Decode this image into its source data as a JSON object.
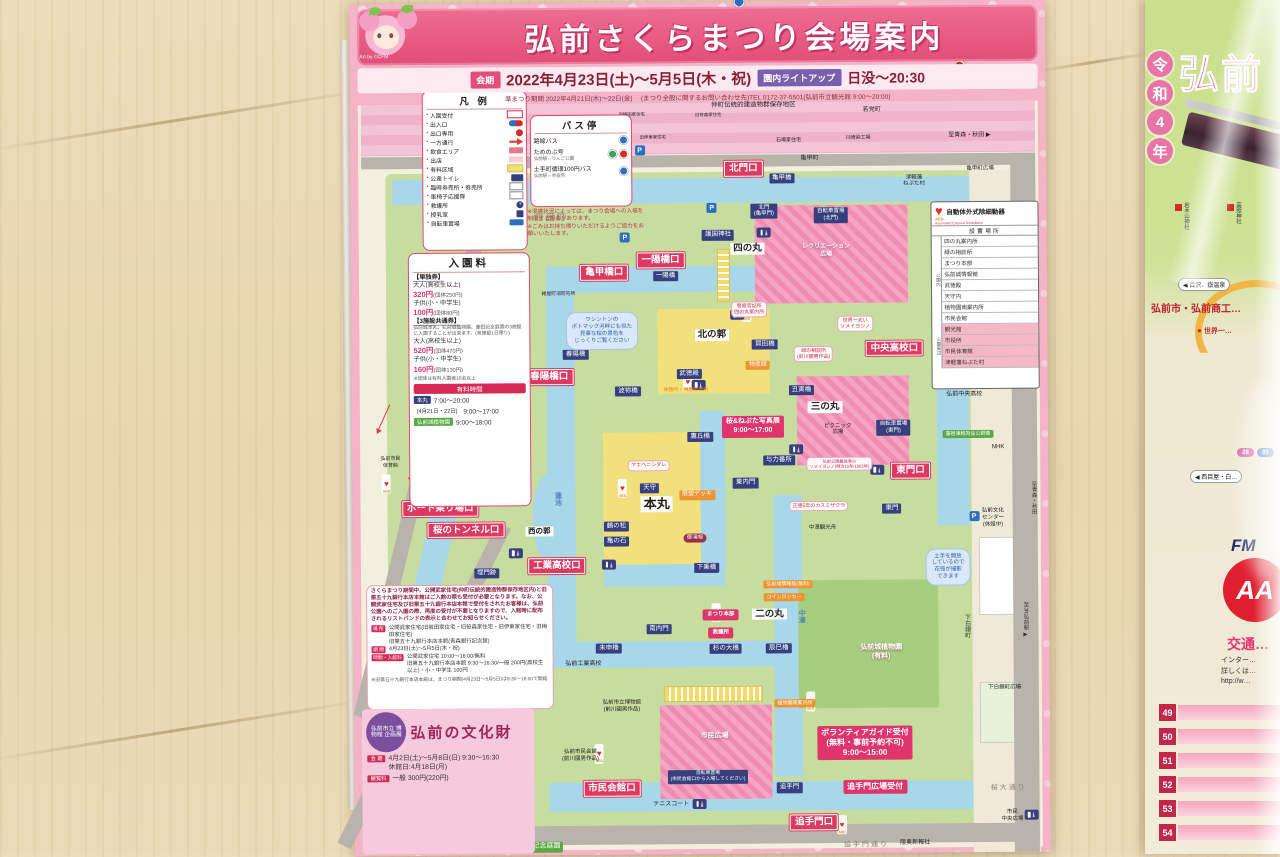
{
  "brochure": {
    "title": "弘前さくらまつり会場案内",
    "art_credit": "Art by ©CFM",
    "period_label": "会期",
    "period": "2022年4月23日(土)〜5月5日(木・祝)",
    "lightup_label": "園内ライトアップ",
    "lightup_time": "日没〜20:30",
    "sub_period": "準まつり期間 2022年4月21日(木)〜22日(金)",
    "contact": "(まつり全般に関するお問い合わせ先)TEL.0172-37-5501(弘前市立観光館 9:00〜20:00)"
  },
  "legend": {
    "title": "凡 例",
    "items": [
      {
        "label": "入園受付",
        "swatch": "reception"
      },
      {
        "label": "出入口",
        "swatch": "inout"
      },
      {
        "label": "出口専用",
        "swatch": "exit"
      },
      {
        "label": "一方通行",
        "swatch": "oneway"
      },
      {
        "label": "飲食エリア",
        "swatch": "food"
      },
      {
        "label": "出店",
        "swatch": "stall"
      },
      {
        "label": "有料区域",
        "swatch": "paid"
      },
      {
        "label": "公衆トイレ",
        "swatch": "toilet"
      },
      {
        "label": "臨時券売所・券売所",
        "swatch": "ticket"
      },
      {
        "label": "車椅子応援隊",
        "swatch": "wheel"
      },
      {
        "label": "救護所",
        "swatch": "aid"
      },
      {
        "label": "授乳室",
        "swatch": "nursing"
      },
      {
        "label": "自転車置場",
        "swatch": "bicycle"
      }
    ]
  },
  "bus": {
    "title": "バス停",
    "items": [
      {
        "label": "路線バス",
        "sub": "",
        "marks": [
          "b"
        ]
      },
      {
        "label": "ためのぶ号",
        "sub": "弘前駅⇔りんご公園",
        "marks": [
          "g",
          "r"
        ]
      },
      {
        "label": "土手町循環100円バス",
        "sub": "弘前駅⇔市役所",
        "marks": [
          "b"
        ]
      }
    ],
    "notes": [
      "※混雑状況によっては、まつり会場への入場を制限する場合があります。",
      "※ごみはお持ち帰りいただけるようご協力をお願いいたします。"
    ]
  },
  "admission": {
    "title": "入園料",
    "single_label": "【単独券】",
    "single": [
      {
        "who": "大人(高校生以上)",
        "price": "320円",
        "group": "(団体250円)"
      },
      {
        "who": "子供(小・中学生)",
        "price": "100円",
        "group": "(団体80円)"
      }
    ],
    "combo_label": "【3施設共通券】",
    "combo_desc": "弘前城本丸、弘前城植物園、藤田記念庭園の3施設に入園することが出来ます。(各施設1日限り)",
    "combo": [
      {
        "who": "大人(高校生以上)",
        "price": "520円",
        "group": "(団体470円)"
      },
      {
        "who": "子供(小・中学生)",
        "price": "160円",
        "group": "(団体130円)"
      }
    ],
    "group_note": "※団体は有料入園者10名以上",
    "hours_label": "有料時間",
    "hours": [
      {
        "chip": "本丸",
        "style": "navy",
        "time": "7:00〜20:00"
      },
      {
        "chip": "[4月21日・22日]",
        "style": "plain",
        "time": "9:00〜17:00"
      },
      {
        "chip": "弘前城植物園",
        "style": "green",
        "time": "9:00〜18:00"
      }
    ]
  },
  "aed": {
    "logo": "AED",
    "title": "自動体外式除細動器",
    "subtitle": "Automated External Defibrillator",
    "header": "設置場所",
    "in_park_label": "公園内",
    "in_park": [
      "四の丸案内所",
      "緑の相談所",
      "まつり本部",
      "弘前城情報館",
      "武徳殿",
      "天守内",
      "植物園南案内所",
      "市民会館"
    ],
    "around_label": "公園周辺",
    "around": [
      "観光館",
      "市役所",
      "市民体育館",
      "津軽藩ねぷた村"
    ]
  },
  "notice": {
    "text": "さくらまつり期間中、公開武家住宅(仲町伝統的建造物群保存地区内)と旧第五十九銀行本店本館はご入館の際も受付が必要となります。なお、公開武家住宅及び旧第五十九銀行本店本館で受付をされたお客様は、弘前公園へのご入園の際、再度の受付が不要となりますので、入館時に配布されるリストバンドの表示と合わせてお知らせください。",
    "rows": [
      {
        "chip": "場 所",
        "text": "公開武家住宅(旧岩田家住宅・旧笹森家住宅・旧伊東家住宅・旧梅田家住宅)\n旧第五十九銀行本店本館(青森銀行記念館)"
      },
      {
        "chip": "期 間",
        "text": "4月23日(土)〜5月5日(木・祝)"
      },
      {
        "chip": "時間・入館料",
        "text": "公開武家住宅 10:00〜16:00/無料\n旧第五十九銀行本店本館 9:30〜16:30/一般 200円(高校生以上)・小・中学生 100円"
      }
    ],
    "footnote": "※旧第五十九銀行本店本館は、まつり期間(4月23日〜5月5日)は9:30〜18:00で開館"
  },
  "bunkazai": {
    "badge": "弘前市立 博物館 企画展",
    "title": "弘前の文化財",
    "rows": [
      {
        "chip": "会 期",
        "text": "4月2日(土)〜5月8日(日) 9:30〜16:30\n休館日:4月18日(月)"
      },
      {
        "chip": "観覧料",
        "text": "一般 300円(220円)"
      }
    ]
  },
  "map": {
    "labels": [
      {
        "t": "北門口",
        "k": "g",
        "x": 56.5,
        "y": 19.6
      },
      {
        "t": "一陽橋口",
        "k": "g",
        "x": 44.5,
        "y": 30.3
      },
      {
        "t": "亀甲橋口",
        "k": "g",
        "x": 36.4,
        "y": 31.7
      },
      {
        "t": "春陽橋口",
        "k": "g",
        "x": 28.4,
        "y": 43.9
      },
      {
        "t": "市民体育館口",
        "k": "g",
        "x": 14.5,
        "y": 55.8
      },
      {
        "t": "ボート乗り場口",
        "k": "g",
        "x": 12.6,
        "y": 59.3
      },
      {
        "t": "桜のトンネル口",
        "k": "g",
        "x": 16.3,
        "y": 61.8
      },
      {
        "t": "工業高校口",
        "k": "g",
        "x": 29.3,
        "y": 66.1
      },
      {
        "t": "中央高校口",
        "k": "g",
        "x": 78,
        "y": 40.8
      },
      {
        "t": "東門口",
        "k": "g",
        "x": 80.2,
        "y": 55.2
      },
      {
        "t": "市民会館口",
        "k": "g",
        "x": 37,
        "y": 92.3
      },
      {
        "t": "追手門口",
        "k": "g",
        "x": 66,
        "y": 96.4
      },
      {
        "t": "亀甲橋",
        "k": "n",
        "x": 62,
        "y": 20.8
      },
      {
        "t": "北門\n(亀甲門)",
        "k": "n",
        "x": 59.4,
        "y": 24.6,
        "fs": 5.5
      },
      {
        "t": "自転車置場\n(北門)",
        "k": "n",
        "x": 69,
        "y": 25.1,
        "fs": 5.5
      },
      {
        "t": "護国神社",
        "k": "n",
        "x": 52.8,
        "y": 27.4
      },
      {
        "t": "一陽橋",
        "k": "n",
        "x": 45.2,
        "y": 32.2
      },
      {
        "t": "春陽橋",
        "k": "n",
        "x": 32.2,
        "y": 41.3
      },
      {
        "t": "波祢橋",
        "k": "n",
        "x": 39.7,
        "y": 45.7
      },
      {
        "t": "武徳殿",
        "k": "n",
        "x": 48.5,
        "y": 43.7
      },
      {
        "t": "賀田橋",
        "k": "n",
        "x": 59.4,
        "y": 40.2
      },
      {
        "t": "丑寅櫓",
        "k": "n",
        "x": 64.6,
        "y": 45.6
      },
      {
        "t": "鷹丘橋",
        "k": "n",
        "x": 50,
        "y": 51
      },
      {
        "t": "天守",
        "k": "n",
        "x": 42.7,
        "y": 57
      },
      {
        "t": "与力番所",
        "k": "n",
        "x": 61.3,
        "y": 53.9
      },
      {
        "t": "東内門",
        "k": "n",
        "x": 56.5,
        "y": 56.5
      },
      {
        "t": "鶴の松",
        "k": "n",
        "x": 37.9,
        "y": 61.5
      },
      {
        "t": "亀の石",
        "k": "n",
        "x": 37.9,
        "y": 63.3
      },
      {
        "t": "下乗橋",
        "k": "n",
        "x": 50.8,
        "y": 66.4
      },
      {
        "t": "南内門",
        "k": "n",
        "x": 43.9,
        "y": 73.6
      },
      {
        "t": "未申櫓",
        "k": "n",
        "x": 36.7,
        "y": 75.8
      },
      {
        "t": "杉の大橋",
        "k": "n",
        "x": 53.5,
        "y": 75.9
      },
      {
        "t": "辰巳櫓",
        "k": "n",
        "x": 61.1,
        "y": 75.9
      },
      {
        "t": "埋門跡",
        "k": "n",
        "x": 19.2,
        "y": 66.9
      },
      {
        "t": "東門",
        "k": "n",
        "x": 77.5,
        "y": 59.6
      },
      {
        "t": "追手門",
        "k": "n",
        "x": 62.5,
        "y": 92.3
      },
      {
        "t": "自転車置場\n(東門)",
        "k": "n",
        "x": 77.8,
        "y": 50.1,
        "fs": 5.5
      },
      {
        "t": "自転車置場\n(市民会館口から入場してください)",
        "k": "n",
        "x": 50.8,
        "y": 91,
        "fs": 4.8
      },
      {
        "t": "四の丸",
        "k": "w",
        "x": 57,
        "y": 29
      },
      {
        "t": "北の郭",
        "k": "w",
        "x": 51.8,
        "y": 39.1
      },
      {
        "t": "三の丸",
        "k": "w",
        "x": 68,
        "y": 47.7
      },
      {
        "t": "本丸",
        "k": "w",
        "x": 43.7,
        "y": 58.9,
        "fs": 13
      },
      {
        "t": "二の丸",
        "k": "w",
        "x": 59.8,
        "y": 71.9
      },
      {
        "t": "西の郭",
        "k": "w",
        "x": 26.8,
        "y": 62,
        "fs": 7.5
      },
      {
        "t": "市民広場",
        "k": "wl",
        "x": 51.8,
        "y": 86.3
      },
      {
        "t": "レクリエーション\n広場",
        "k": "wl",
        "x": 68.3,
        "y": 29.4,
        "fs": 6
      },
      {
        "t": "弘前城植物園\n(有料)",
        "k": "wl",
        "x": 75.8,
        "y": 76.5
      },
      {
        "t": "展望デッキ",
        "k": "o",
        "x": 49.5,
        "y": 57.9
      },
      {
        "t": "物産館",
        "k": "o",
        "x": 58.4,
        "y": 42.7
      },
      {
        "t": "弘前城情報館(無料)",
        "k": "o",
        "x": 62.5,
        "y": 68.4,
        "fs": 5
      },
      {
        "t": "コインロッカー",
        "k": "o",
        "x": 61.9,
        "y": 69.9,
        "fs": 5
      },
      {
        "t": "植物園南案内所",
        "k": "o",
        "x": 63.4,
        "y": 82.4,
        "fs": 5
      },
      {
        "t": "休憩所・物産販売所",
        "k": "ot",
        "x": 48,
        "y": 45.5
      },
      {
        "t": "桜&ねぷた写真展\n9:00〜17:00",
        "k": "p",
        "x": 57.6,
        "y": 49.9
      },
      {
        "t": "まつり本部",
        "k": "p",
        "x": 52.8,
        "y": 72,
        "fs": 5.5
      },
      {
        "t": "救護所",
        "k": "p",
        "x": 52.8,
        "y": 74.1,
        "fs": 5.5
      },
      {
        "t": "ボランティアガイド受付\n(無料・事前予約不可)\n9:00〜15:00",
        "k": "p",
        "x": 73.4,
        "y": 87.1,
        "fs": 8
      },
      {
        "t": "追手門広場受付",
        "k": "p",
        "x": 74.8,
        "y": 92.3,
        "fs": 8
      },
      {
        "t": "御滝桜",
        "k": "d",
        "x": 49.2,
        "y": 62.9
      },
      {
        "t": "ヤエベニシダレ",
        "k": "r",
        "x": 42.6,
        "y": 54.4
      },
      {
        "t": "正徳5年のカスミザクラ",
        "k": "r",
        "x": 67,
        "y": 59.3
      },
      {
        "t": "世界一太い\nソメイヨシノ",
        "k": "r",
        "x": 72.4,
        "y": 37.9
      },
      {
        "t": "緑の相談所\n(前川國男作品)",
        "k": "r",
        "x": 66.4,
        "y": 41.4
      },
      {
        "t": "警察官詰所\n四の丸案内所",
        "k": "r",
        "x": 57.2,
        "y": 36.1
      },
      {
        "t": "弘前公園最長寿の\nソメイヨシノ(明治15年/1882年)",
        "k": "r",
        "x": 70,
        "y": 54.3,
        "fs": 4.2
      },
      {
        "t": "ワシントンの\nポトマック河畔にも似た\n見事な桜の景色を\nじっくりご覧ください",
        "k": "c",
        "x": 36,
        "y": 38.5
      },
      {
        "t": "土手を開放\nしているので\n花筏が撮影\nできます",
        "k": "c",
        "x": 85.5,
        "y": 66.5
      },
      {
        "t": "紺屋町消防屯所",
        "k": "b",
        "x": 29.8,
        "y": 34.3,
        "fs": 4.8
      },
      {
        "t": "弘前市民\n体育館",
        "k": "b",
        "x": 5.5,
        "y": 53.8,
        "fs": 5
      },
      {
        "t": "弘前工業高校",
        "k": "b",
        "x": 33,
        "y": 77.7
      },
      {
        "t": "弘前中央高校",
        "k": "b",
        "x": 88,
        "y": 46.4
      },
      {
        "t": "NHK",
        "k": "b",
        "x": 92.8,
        "y": 52.6
      },
      {
        "t": "弘前文化\nセンター\n(休館中)",
        "k": "b",
        "x": 92,
        "y": 60.8,
        "fs": 5.5
      },
      {
        "t": "津軽藩\nねぷた村",
        "k": "b",
        "x": 81,
        "y": 21.2,
        "fs": 5.5
      },
      {
        "t": "亀甲町広場",
        "k": "b",
        "x": 90.5,
        "y": 19.8,
        "fs": 5.5
      },
      {
        "t": "川崎染工場",
        "k": "b",
        "x": 73,
        "y": 16.1,
        "fs": 5
      },
      {
        "t": "石場家住宅",
        "k": "b",
        "x": 63,
        "y": 16.3,
        "fs": 5
      },
      {
        "t": "旧梅田家住宅",
        "k": "b",
        "x": 40.5,
        "y": 13.2,
        "fs": 4.4
      },
      {
        "t": "旧伊東家住宅",
        "k": "b",
        "x": 43.5,
        "y": 15.9,
        "fs": 4.4
      },
      {
        "t": "旧笹森家住宅",
        "k": "b",
        "x": 51.5,
        "y": 13.3,
        "fs": 4.4
      },
      {
        "t": "仲町伝統的建造物群保存地区",
        "k": "b",
        "x": 58,
        "y": 12.2,
        "fs": 6.5
      },
      {
        "t": "若党町",
        "k": "b",
        "x": 75,
        "y": 12.9
      },
      {
        "t": "亀甲町",
        "k": "b",
        "x": 66,
        "y": 18.5
      },
      {
        "t": "ピクニック\n広場",
        "k": "b",
        "x": 69.8,
        "y": 50.3,
        "fs": 5.5
      },
      {
        "t": "中濠観光舟",
        "k": "b",
        "x": 67.5,
        "y": 61.9,
        "fs": 5.5
      },
      {
        "t": "下白銀町広場",
        "k": "b",
        "x": 93.5,
        "y": 80.8,
        "fs": 5.5
      },
      {
        "t": "桜大通り",
        "k": "gy",
        "x": 94,
        "y": 92.6,
        "fs": 7
      },
      {
        "t": "市民\n中央広場",
        "k": "b",
        "x": 94.5,
        "y": 95.8,
        "fs": 5.5
      },
      {
        "t": "陸奥新報社",
        "k": "b",
        "x": 80.5,
        "y": 99
      },
      {
        "t": "テニスコート",
        "k": "b",
        "x": 45.5,
        "y": 94.3
      },
      {
        "t": "弘前市立博物館\n(前川國男作品)",
        "k": "b",
        "x": 38.5,
        "y": 82.6,
        "fs": 5.5
      },
      {
        "t": "弘前市民会館\n(前川國男作品)",
        "k": "b",
        "x": 32.5,
        "y": 88.4,
        "fs": 5.5
      },
      {
        "t": "追手門通り",
        "k": "gy",
        "x": 73.5,
        "y": 99.2,
        "fs": 7
      },
      {
        "t": "至青森・秋田 ▶",
        "k": "b",
        "x": 89,
        "y": 16
      },
      {
        "t": "紺屋町",
        "k": "gy",
        "x": 28.8,
        "y": 25.2
      },
      {
        "t": "藩祖津軽為信公銅像",
        "k": "gr",
        "x": 88.5,
        "y": 50.9,
        "fs": 5
      },
      {
        "t": "藤田記念庭園",
        "k": "gr",
        "x": 26.5,
        "y": 99.1,
        "fs": 7
      },
      {
        "t": "中濠",
        "k": "vb",
        "x": 64.3,
        "y": 72.2,
        "v": true
      },
      {
        "t": "蓮池",
        "k": "vb",
        "x": 29.4,
        "y": 58.2,
        "v": true
      },
      {
        "t": "下白銀町",
        "k": "v",
        "x": 88,
        "y": 73.5,
        "v": true
      },
      {
        "t": "至JR弘前駅 ▶",
        "k": "v",
        "x": 96.5,
        "y": 72.8,
        "v": true,
        "fs": 5.5
      },
      {
        "t": "至青森・秋田",
        "k": "v",
        "x": 97.8,
        "y": 58.5,
        "v": true,
        "fs": 5.5
      }
    ],
    "icons": [
      {
        "k": "aed",
        "x": 38.8,
        "y": 57
      },
      {
        "k": "aed",
        "x": 52.1,
        "y": 71.7
      },
      {
        "k": "aed",
        "x": 65.6,
        "y": 82.2
      },
      {
        "k": "aed",
        "x": 35.2,
        "y": 88.2
      },
      {
        "k": "aed",
        "x": 56.8,
        "y": 36.4
      },
      {
        "k": "aed",
        "x": 48.3,
        "y": 44.6
      },
      {
        "k": "aed",
        "x": 70,
        "y": 96.7
      },
      {
        "k": "aed",
        "x": 4.9,
        "y": 56.3
      },
      {
        "k": "toilet",
        "x": 59.4,
        "y": 27.1
      },
      {
        "k": "toilet",
        "x": 55.4,
        "y": 36.7
      },
      {
        "k": "toilet",
        "x": 49.8,
        "y": 45
      },
      {
        "k": "toilet",
        "x": 36.8,
        "y": 66
      },
      {
        "k": "toilet",
        "x": 63.8,
        "y": 52.6
      },
      {
        "k": "toilet",
        "x": 75.4,
        "y": 55.1
      },
      {
        "k": "toilet",
        "x": 49.6,
        "y": 94.1
      },
      {
        "k": "toilet",
        "x": 97.2,
        "y": 95.6
      },
      {
        "k": "toilet",
        "x": 23.4,
        "y": 64.5
      },
      {
        "k": "p",
        "x": 41.6,
        "y": 17.4
      },
      {
        "k": "p",
        "x": 51.9,
        "y": 24.2
      },
      {
        "k": "p",
        "x": 87.6,
        "y": 38.4
      },
      {
        "k": "p",
        "x": 89.3,
        "y": 60.6
      },
      {
        "k": "p",
        "x": 39.4,
        "y": 27.6
      },
      {
        "k": "bus-b",
        "x": 56,
        "y": 20.1
      },
      {
        "k": "bus-b",
        "x": 70.2,
        "y": 17.7
      },
      {
        "k": "bus-b",
        "x": 97.1,
        "y": 92
      },
      {
        "k": "bus-g",
        "x": 86.2,
        "y": 40.3
      },
      {
        "k": "bus-g",
        "x": 94.8,
        "y": 55.4
      },
      {
        "k": "noentry",
        "x": 35.1,
        "y": 95.2
      },
      {
        "k": "noentry",
        "x": 87.6,
        "y": 41.6
      },
      {
        "k": "noentry",
        "x": 33.5,
        "y": 33.4
      }
    ],
    "arrows": [
      {
        "x": 23,
        "y": 34.5,
        "r": 78,
        "l": 40
      },
      {
        "x": 20,
        "y": 44,
        "r": 95,
        "l": 34
      },
      {
        "x": 12.5,
        "y": 51.5,
        "r": 30,
        "l": 28
      },
      {
        "x": 15,
        "y": 58.5,
        "r": 205,
        "l": 30
      },
      {
        "x": 5.5,
        "y": 47,
        "r": 115,
        "l": 30
      },
      {
        "x": 8,
        "y": 55.5,
        "r": 60,
        "l": 26
      }
    ]
  },
  "right": {
    "era_chars": [
      "令",
      "和",
      "4",
      "年"
    ],
    "title_fragment": "弘前",
    "publisher": "弘前市・弘前商工…",
    "shrines": [
      "岩木山神社",
      "高照神社"
    ],
    "route_badges": [
      "28",
      "85"
    ],
    "arrow_badges": [
      "◀ 百沢、嶽温泉",
      "◀ 西目屋・白…"
    ],
    "world_one": "世界一…",
    "fm": "FM",
    "aa": "AA",
    "traffic": "交通…",
    "lines": [
      "インター…",
      "詳しくは…",
      "http://w…"
    ],
    "row_numbers": [
      "49",
      "50",
      "51",
      "52",
      "53",
      "54"
    ]
  }
}
